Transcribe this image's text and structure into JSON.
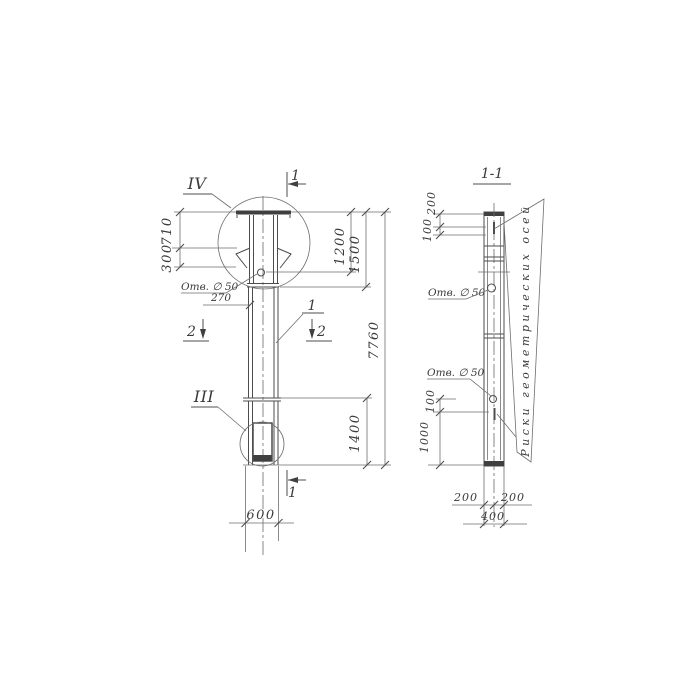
{
  "left_view": {
    "detail_top_label": "IV",
    "detail_bottom_label": "III",
    "section_top_label": "1",
    "section_bottom_label": "1",
    "section2_left_label": "2",
    "section2_right_label": "2",
    "position_label": "1",
    "dim_710": "710",
    "dim_300": "300",
    "dim_270": "270",
    "dim_1200": "1200",
    "dim_1500": "1500",
    "dim_7760": "7760",
    "dim_1400": "1400",
    "dim_600": "600",
    "hole_label": "Отв. ∅ 50"
  },
  "right_view": {
    "title": "1-1",
    "dim_200_top": "200",
    "dim_100_top": "100",
    "dim_100_mid": "100",
    "dim_1000": "1000",
    "dim_200_bottom_left": "200",
    "dim_200_bottom_right": "200",
    "dim_400_bottom": "400",
    "hole_label_upper": "Отв. ∅ 50",
    "hole_label_lower": "Отв. ∅ 50",
    "axes_note": "Риски геометрических осей"
  },
  "colors": {
    "line": "#4d4d4d",
    "aux_line": "#6e6e6e",
    "text": "#3a3a3a",
    "background": "#ffffff"
  }
}
